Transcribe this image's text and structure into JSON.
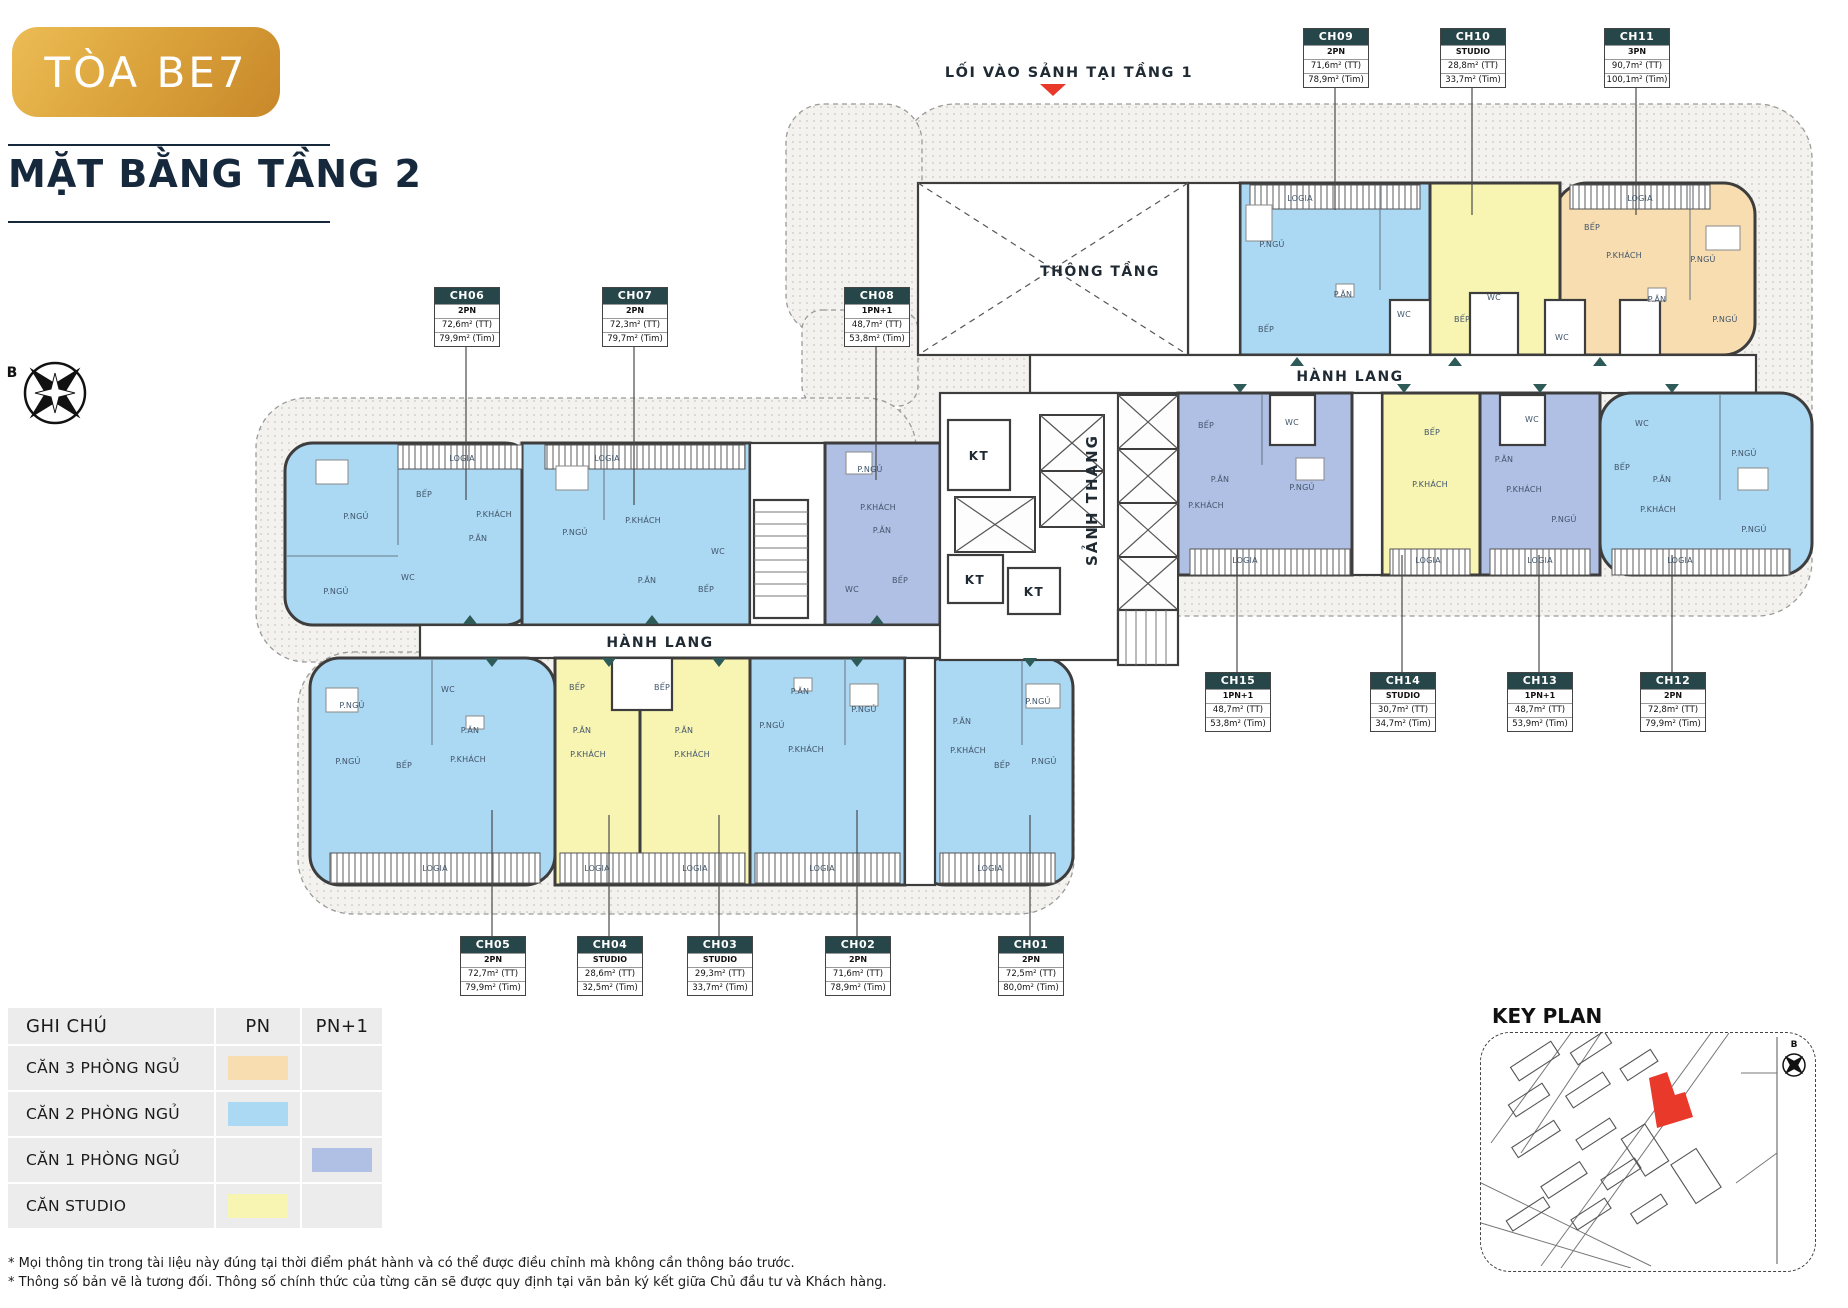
{
  "header": {
    "badge": "TÒA BE7",
    "title": "MẶT BẰNG TẦNG 2"
  },
  "plan": {
    "entry_label": "LỐI VÀO SẢNH TẠI TẦNG 1",
    "void_label": "THÔNG TẦNG",
    "corridor_label": "HÀNH LANG",
    "stair_lobby_label": "SẢNH THANG",
    "shaft_label": "KT",
    "north_label": "B",
    "room_labels": [
      {
        "x": 462,
        "y": 461,
        "k": "logia"
      },
      {
        "x": 607,
        "y": 461,
        "k": "logia"
      },
      {
        "x": 356,
        "y": 519,
        "k": "bedroom"
      },
      {
        "x": 424,
        "y": 497,
        "k": "kitchen"
      },
      {
        "x": 494,
        "y": 517,
        "k": "living"
      },
      {
        "x": 478,
        "y": 541,
        "k": "dining"
      },
      {
        "x": 336,
        "y": 594,
        "k": "bedroom"
      },
      {
        "x": 408,
        "y": 580,
        "k": "wc"
      },
      {
        "x": 575,
        "y": 535,
        "k": "bedroom"
      },
      {
        "x": 643,
        "y": 523,
        "k": "living"
      },
      {
        "x": 647,
        "y": 583,
        "k": "dining"
      },
      {
        "x": 706,
        "y": 592,
        "k": "kitchen"
      },
      {
        "x": 718,
        "y": 554,
        "k": "wc"
      },
      {
        "x": 870,
        "y": 472,
        "k": "bedroom"
      },
      {
        "x": 878,
        "y": 510,
        "k": "living"
      },
      {
        "x": 882,
        "y": 533,
        "k": "dining"
      },
      {
        "x": 900,
        "y": 583,
        "k": "kitchen"
      },
      {
        "x": 852,
        "y": 592,
        "k": "wc"
      },
      {
        "x": 1300,
        "y": 201,
        "k": "logia"
      },
      {
        "x": 1640,
        "y": 201,
        "k": "logia"
      },
      {
        "x": 1272,
        "y": 247,
        "k": "bedroom"
      },
      {
        "x": 1343,
        "y": 297,
        "k": "dining"
      },
      {
        "x": 1404,
        "y": 317,
        "k": "wc"
      },
      {
        "x": 1266,
        "y": 332,
        "k": "kitchen"
      },
      {
        "x": 1462,
        "y": 322,
        "k": "kitchen"
      },
      {
        "x": 1494,
        "y": 300,
        "k": "wc"
      },
      {
        "x": 1592,
        "y": 230,
        "k": "kitchen"
      },
      {
        "x": 1624,
        "y": 258,
        "k": "living"
      },
      {
        "x": 1703,
        "y": 262,
        "k": "bedroom"
      },
      {
        "x": 1657,
        "y": 302,
        "k": "dining"
      },
      {
        "x": 1562,
        "y": 340,
        "k": "wc"
      },
      {
        "x": 1725,
        "y": 322,
        "k": "bedroom"
      },
      {
        "x": 1245,
        "y": 563,
        "k": "logia"
      },
      {
        "x": 1428,
        "y": 563,
        "k": "logia"
      },
      {
        "x": 1540,
        "y": 563,
        "k": "logia"
      },
      {
        "x": 1680,
        "y": 563,
        "k": "logia"
      },
      {
        "x": 1206,
        "y": 428,
        "k": "kitchen"
      },
      {
        "x": 1220,
        "y": 482,
        "k": "dining"
      },
      {
        "x": 1206,
        "y": 508,
        "k": "living"
      },
      {
        "x": 1302,
        "y": 490,
        "k": "bedroom"
      },
      {
        "x": 1292,
        "y": 425,
        "k": "wc"
      },
      {
        "x": 1432,
        "y": 435,
        "k": "kitchen"
      },
      {
        "x": 1430,
        "y": 487,
        "k": "living"
      },
      {
        "x": 1504,
        "y": 462,
        "k": "dining"
      },
      {
        "x": 1524,
        "y": 492,
        "k": "living"
      },
      {
        "x": 1564,
        "y": 522,
        "k": "bedroom"
      },
      {
        "x": 1532,
        "y": 422,
        "k": "wc"
      },
      {
        "x": 1642,
        "y": 426,
        "k": "wc"
      },
      {
        "x": 1662,
        "y": 482,
        "k": "dining"
      },
      {
        "x": 1658,
        "y": 512,
        "k": "living"
      },
      {
        "x": 1744,
        "y": 456,
        "k": "bedroom"
      },
      {
        "x": 1754,
        "y": 532,
        "k": "bedroom"
      },
      {
        "x": 1622,
        "y": 470,
        "k": "kitchen"
      },
      {
        "x": 435,
        "y": 871,
        "k": "logia"
      },
      {
        "x": 597,
        "y": 871,
        "k": "logia"
      },
      {
        "x": 695,
        "y": 871,
        "k": "logia"
      },
      {
        "x": 822,
        "y": 871,
        "k": "logia"
      },
      {
        "x": 990,
        "y": 871,
        "k": "logia"
      },
      {
        "x": 352,
        "y": 708,
        "k": "bedroom"
      },
      {
        "x": 470,
        "y": 733,
        "k": "dining"
      },
      {
        "x": 348,
        "y": 764,
        "k": "bedroom"
      },
      {
        "x": 404,
        "y": 768,
        "k": "kitchen"
      },
      {
        "x": 468,
        "y": 762,
        "k": "living"
      },
      {
        "x": 448,
        "y": 692,
        "k": "wc"
      },
      {
        "x": 577,
        "y": 690,
        "k": "kitchen"
      },
      {
        "x": 582,
        "y": 733,
        "k": "dining"
      },
      {
        "x": 588,
        "y": 757,
        "k": "living"
      },
      {
        "x": 662,
        "y": 690,
        "k": "kitchen"
      },
      {
        "x": 684,
        "y": 733,
        "k": "dining"
      },
      {
        "x": 692,
        "y": 757,
        "k": "living"
      },
      {
        "x": 800,
        "y": 694,
        "k": "dining"
      },
      {
        "x": 772,
        "y": 728,
        "k": "bedroom"
      },
      {
        "x": 806,
        "y": 752,
        "k": "living"
      },
      {
        "x": 864,
        "y": 712,
        "k": "bedroom"
      },
      {
        "x": 1038,
        "y": 704,
        "k": "bedroom"
      },
      {
        "x": 962,
        "y": 724,
        "k": "dining"
      },
      {
        "x": 968,
        "y": 753,
        "k": "living"
      },
      {
        "x": 1002,
        "y": 768,
        "k": "kitchen"
      },
      {
        "x": 1044,
        "y": 764,
        "k": "bedroom"
      }
    ]
  },
  "rooms": {
    "bedroom": "P.NGỦ",
    "living": "P.KHÁCH",
    "dining": "P.ĂN",
    "kitchen": "BẾP",
    "wc": "WC",
    "logia": "LOGIA"
  },
  "units": [
    {
      "id": "CH01",
      "type": "2PN",
      "area_tt": "72,5m² (TT)",
      "area_tim": "80,0m² (Tim)",
      "category": "two_bed"
    },
    {
      "id": "CH02",
      "type": "2PN",
      "area_tt": "71,6m² (TT)",
      "area_tim": "78,9m² (Tim)",
      "category": "two_bed"
    },
    {
      "id": "CH03",
      "type": "STUDIO",
      "area_tt": "29,3m² (TT)",
      "area_tim": "33,7m² (Tim)",
      "category": "studio"
    },
    {
      "id": "CH04",
      "type": "STUDIO",
      "area_tt": "28,6m² (TT)",
      "area_tim": "32,5m² (Tim)",
      "category": "studio"
    },
    {
      "id": "CH05",
      "type": "2PN",
      "area_tt": "72,7m² (TT)",
      "area_tim": "79,9m² (Tim)",
      "category": "two_bed"
    },
    {
      "id": "CH06",
      "type": "2PN",
      "area_tt": "72,6m² (TT)",
      "area_tim": "79,9m² (Tim)",
      "category": "two_bed"
    },
    {
      "id": "CH07",
      "type": "2PN",
      "area_tt": "72,3m² (TT)",
      "area_tim": "79,7m² (Tim)",
      "category": "two_bed"
    },
    {
      "id": "CH08",
      "type": "1PN+1",
      "area_tt": "48,7m² (TT)",
      "area_tim": "53,8m² (Tim)",
      "category": "one_bed_plus"
    },
    {
      "id": "CH09",
      "type": "2PN",
      "area_tt": "71,6m² (TT)",
      "area_tim": "78,9m² (Tim)",
      "category": "two_bed"
    },
    {
      "id": "CH10",
      "type": "STUDIO",
      "area_tt": "28,8m² (TT)",
      "area_tim": "33,7m² (Tim)",
      "category": "studio"
    },
    {
      "id": "CH11",
      "type": "3PN",
      "area_tt": "90,7m² (TT)",
      "area_tim": "100,1m² (Tim)",
      "category": "three_bed"
    },
    {
      "id": "CH12",
      "type": "2PN",
      "area_tt": "72,8m² (TT)",
      "area_tim": "79,9m² (Tim)",
      "category": "two_bed"
    },
    {
      "id": "CH13",
      "type": "1PN+1",
      "area_tt": "48,7m² (TT)",
      "area_tim": "53,9m² (Tim)",
      "category": "one_bed_plus"
    },
    {
      "id": "CH14",
      "type": "STUDIO",
      "area_tt": "30,7m² (TT)",
      "area_tim": "34,7m² (Tim)",
      "category": "studio"
    },
    {
      "id": "CH15",
      "type": "1PN+1",
      "area_tt": "48,7m² (TT)",
      "area_tim": "53,8m² (Tim)",
      "category": "one_bed_plus"
    }
  ],
  "legend": {
    "title": "GHI CHÚ",
    "col_pn": "PN",
    "col_pn1": "PN+1",
    "rows": [
      {
        "label": "CĂN 3 PHÒNG NGỦ",
        "column": "PN",
        "color": "#f8ddb0"
      },
      {
        "label": "CĂN 2 PHÒNG NGỦ",
        "column": "PN",
        "color": "#abd8f2"
      },
      {
        "label": "CĂN 1 PHÒNG NGỦ",
        "column": "PN+1",
        "color": "#afc0e4"
      },
      {
        "label": "CĂN STUDIO",
        "column": "PN",
        "color": "#f8f4b2"
      }
    ]
  },
  "keyplan": {
    "title": "KEY PLAN",
    "north_label": "B",
    "highlight_color": "#e8392b"
  },
  "colors": {
    "two_bed": "#abd8f2",
    "three_bed": "#f8ddb0",
    "one_bed_plus": "#afc0e4",
    "studio": "#f8f4b2",
    "wall": "#3d3d3d",
    "label_header": "#27464a",
    "accent_teal": "#2e5a57",
    "title_navy": "#16283c",
    "badge_gold": "#d99e32",
    "entry_red": "#e8392b"
  },
  "footnotes": [
    "* Mọi thông tin trong tài liệu này đúng tại thời điểm phát hành và có thể được điều chỉnh mà không cần thông báo trước.",
    "* Thông số bản vẽ là tương đối. Thông số chính thức của từng căn sẽ được quy định tại văn bản ký kết giữa Chủ đầu tư và Khách hàng."
  ]
}
